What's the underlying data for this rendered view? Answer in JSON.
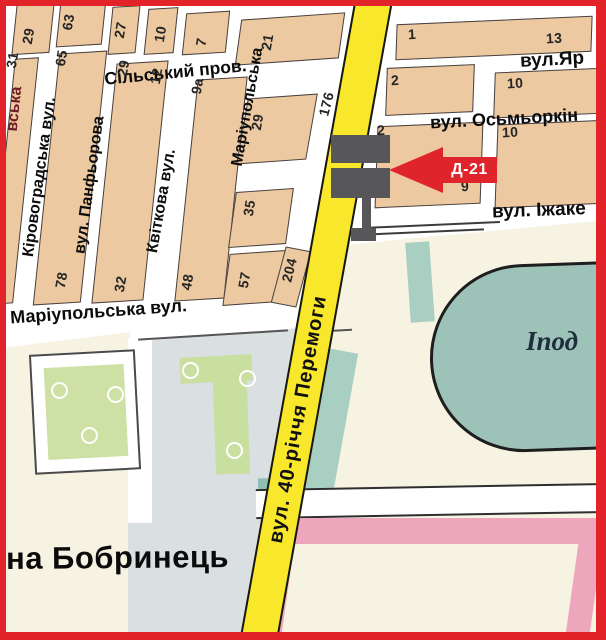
{
  "map": {
    "marker_label": "Д-21",
    "direction_sign": "на Бобринець",
    "hippodrome_label": "Іпод",
    "edge_street_fragment": "вська",
    "streets": {
      "silskyi": "Сільський пров.",
      "mariupolska_h": "Маріупольська вул.",
      "kirovohradska": "Кіровоградська вул.",
      "panfiorova": "вул. Панфьорова",
      "kvitkova": "Квіткова вул.",
      "mariupolska_v": "Маріупольська",
      "peremohy": "вул. 40-річчя Перемоги",
      "yar": "вул.Яр",
      "osmorkin": "вул. Осьмьоркін",
      "izhakevycha": "вул. Іжаке"
    },
    "house_numbers": [
      "29",
      "63",
      "27",
      "10",
      "7",
      "21",
      "31",
      "65",
      "29",
      "12",
      "9а",
      "78",
      "32",
      "48",
      "35",
      "57",
      "204",
      "29",
      "176",
      "1",
      "13",
      "2",
      "10",
      "2",
      "10",
      "9"
    ],
    "colors": {
      "frame": "#e2242a",
      "road_yellow": "#f8e72b",
      "block_tan": "#ecc9a0",
      "park_green": "#cde1a4",
      "water_teal": "#9dc3b8",
      "zone_pink": "#eea6bd",
      "zone_gray": "#dadfe2",
      "zone_cream": "#f7f3e2",
      "marker_red": "#e0242b",
      "billboard_gray": "#57575a"
    }
  }
}
